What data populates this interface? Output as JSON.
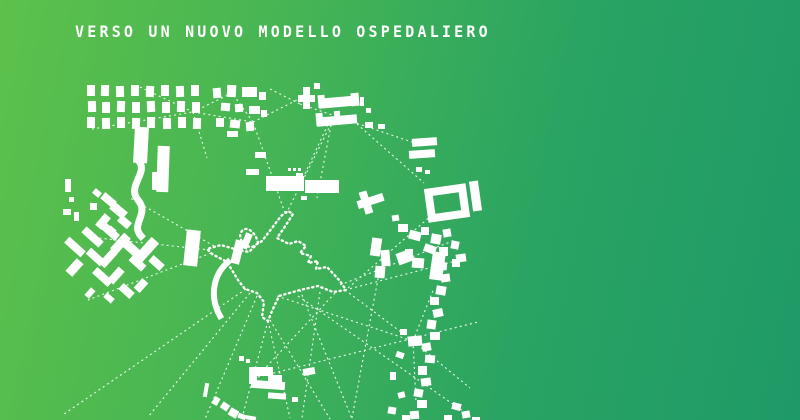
{
  "title": "VERSO UN NUOVO MODELLO OSPEDALIERO",
  "colors": {
    "gradient_left": "#5dc14b",
    "gradient_midleft": "#48b653",
    "gradient_midright": "#2aa462",
    "gradient_right": "#1e9a68",
    "ink": "#ffffff"
  },
  "map": {
    "description": "figure-ground site plan: white building footprints on green, dashed relation lines converging on dotted hospital footprint outline",
    "buildings": [
      [
        87,
        85,
        8,
        11,
        0
      ],
      [
        101,
        85,
        8,
        11,
        2
      ],
      [
        116,
        86,
        8,
        11,
        -2
      ],
      [
        131,
        85,
        8,
        11,
        0
      ],
      [
        146,
        86,
        8,
        11,
        3
      ],
      [
        161,
        85,
        8,
        11,
        0
      ],
      [
        176,
        86,
        8,
        11,
        -2
      ],
      [
        191,
        85,
        8,
        11,
        0
      ],
      [
        88,
        101,
        8,
        11,
        -2
      ],
      [
        102,
        102,
        8,
        11,
        0
      ],
      [
        117,
        101,
        8,
        11,
        2
      ],
      [
        132,
        102,
        8,
        11,
        0
      ],
      [
        147,
        101,
        8,
        11,
        -3
      ],
      [
        162,
        102,
        8,
        11,
        0
      ],
      [
        177,
        101,
        8,
        11,
        2
      ],
      [
        192,
        102,
        8,
        11,
        0
      ],
      [
        87,
        117,
        8,
        11,
        0
      ],
      [
        102,
        118,
        8,
        11,
        -2
      ],
      [
        117,
        117,
        8,
        11,
        0
      ],
      [
        132,
        118,
        8,
        11,
        2
      ],
      [
        147,
        117,
        8,
        11,
        0
      ],
      [
        163,
        118,
        8,
        11,
        -2
      ],
      [
        178,
        117,
        8,
        11,
        0
      ],
      [
        193,
        118,
        8,
        11,
        2
      ],
      [
        213,
        88,
        8,
        10,
        -5
      ],
      [
        227,
        85,
        9,
        12,
        3
      ],
      [
        242,
        87,
        15,
        10,
        0
      ],
      [
        259,
        92,
        7,
        8,
        0
      ],
      [
        221,
        103,
        9,
        8,
        5
      ],
      [
        235,
        104,
        8,
        8,
        -4
      ],
      [
        249,
        106,
        11,
        8,
        0
      ],
      [
        261,
        110,
        6,
        7,
        0
      ],
      [
        216,
        118,
        8,
        9,
        0
      ],
      [
        230,
        120,
        10,
        8,
        6
      ],
      [
        246,
        122,
        8,
        9,
        -5
      ],
      [
        227,
        131,
        11,
        6,
        0
      ],
      [
        303,
        87,
        7,
        22,
        0
      ],
      [
        298,
        95,
        17,
        7,
        0
      ],
      [
        314,
        83,
        6,
        6,
        0
      ],
      [
        318,
        95,
        7,
        13,
        -5
      ],
      [
        319,
        97,
        40,
        10,
        -5
      ],
      [
        351,
        93,
        8,
        13,
        -5
      ],
      [
        316,
        113,
        7,
        13,
        -5
      ],
      [
        317,
        116,
        40,
        9,
        -5
      ],
      [
        334,
        111,
        6,
        5,
        -5
      ],
      [
        365,
        122,
        8,
        6,
        0
      ],
      [
        378,
        124,
        7,
        5,
        0
      ],
      [
        360,
        97,
        4,
        9,
        0
      ],
      [
        366,
        108,
        5,
        5,
        0
      ],
      [
        246,
        169,
        13,
        6,
        0
      ],
      [
        255,
        152,
        11,
        6,
        0
      ],
      [
        288,
        168,
        3,
        3,
        0
      ],
      [
        293,
        168,
        3,
        3,
        0
      ],
      [
        298,
        168,
        3,
        3,
        0
      ],
      [
        266,
        176,
        38,
        15,
        0
      ],
      [
        305,
        180,
        34,
        13,
        0
      ],
      [
        296,
        173,
        7,
        5,
        0
      ],
      [
        301,
        196,
        6,
        4,
        0
      ],
      [
        134,
        127,
        14,
        36,
        3
      ],
      [
        157,
        146,
        12,
        46,
        2
      ],
      [
        152,
        172,
        5,
        18,
        0
      ],
      [
        93,
        190,
        8,
        6,
        40
      ],
      [
        101,
        196,
        15,
        8,
        40
      ],
      [
        90,
        203,
        7,
        7,
        0
      ],
      [
        110,
        206,
        17,
        9,
        40
      ],
      [
        99,
        214,
        8,
        15,
        40
      ],
      [
        118,
        218,
        13,
        8,
        40
      ],
      [
        107,
        227,
        8,
        8,
        40
      ],
      [
        65,
        179,
        6,
        13,
        0
      ],
      [
        69,
        197,
        5,
        5,
        0
      ],
      [
        63,
        209,
        8,
        6,
        0
      ],
      [
        74,
        212,
        5,
        9,
        0
      ],
      [
        64,
        243,
        22,
        8,
        42
      ],
      [
        81,
        233,
        23,
        8,
        42
      ],
      [
        99,
        227,
        21,
        8,
        42
      ],
      [
        116,
        233,
        9,
        21,
        42
      ],
      [
        70,
        259,
        9,
        17,
        42
      ],
      [
        86,
        253,
        19,
        8,
        42
      ],
      [
        104,
        249,
        8,
        19,
        42
      ],
      [
        123,
        245,
        19,
        9,
        42
      ],
      [
        92,
        273,
        21,
        8,
        42
      ],
      [
        112,
        267,
        8,
        17,
        42
      ],
      [
        129,
        259,
        17,
        8,
        42
      ],
      [
        142,
        237,
        10,
        25,
        42
      ],
      [
        149,
        259,
        15,
        8,
        42
      ],
      [
        119,
        287,
        15,
        8,
        42
      ],
      [
        137,
        279,
        8,
        13,
        42
      ],
      [
        104,
        295,
        10,
        6,
        42
      ],
      [
        87,
        288,
        6,
        10,
        42
      ],
      [
        185,
        230,
        14,
        36,
        6
      ],
      [
        233,
        240,
        9,
        24,
        14
      ],
      [
        243,
        233,
        7,
        16,
        22
      ],
      [
        416,
        167,
        6,
        5,
        0
      ],
      [
        425,
        170,
        5,
        4,
        0
      ],
      [
        412,
        138,
        25,
        8,
        -4
      ],
      [
        409,
        150,
        26,
        8,
        -4
      ],
      [
        471,
        181,
        9,
        30,
        -8
      ],
      [
        398,
        224,
        10,
        8,
        0
      ],
      [
        409,
        231,
        12,
        9,
        15
      ],
      [
        421,
        227,
        8,
        8,
        0
      ],
      [
        431,
        234,
        10,
        10,
        10
      ],
      [
        443,
        229,
        8,
        8,
        -10
      ],
      [
        424,
        245,
        12,
        8,
        20
      ],
      [
        439,
        247,
        9,
        9,
        0
      ],
      [
        451,
        241,
        8,
        8,
        12
      ],
      [
        405,
        249,
        8,
        8,
        0
      ],
      [
        456,
        254,
        10,
        8,
        -8
      ],
      [
        397,
        251,
        16,
        12,
        -20
      ],
      [
        412,
        258,
        12,
        10,
        5
      ],
      [
        431,
        252,
        13,
        28,
        8
      ],
      [
        452,
        259,
        8,
        8,
        0
      ],
      [
        437,
        262,
        10,
        8,
        5
      ],
      [
        441,
        274,
        9,
        8,
        -8
      ],
      [
        436,
        286,
        10,
        9,
        10
      ],
      [
        430,
        297,
        9,
        8,
        0
      ],
      [
        433,
        309,
        10,
        8,
        -12
      ],
      [
        427,
        320,
        9,
        9,
        8
      ],
      [
        430,
        332,
        10,
        8,
        0
      ],
      [
        408,
        336,
        14,
        10,
        -5
      ],
      [
        422,
        343,
        9,
        8,
        -10
      ],
      [
        425,
        355,
        10,
        8,
        5
      ],
      [
        418,
        366,
        9,
        9,
        0
      ],
      [
        421,
        378,
        10,
        8,
        -8
      ],
      [
        414,
        389,
        9,
        8,
        10
      ],
      [
        417,
        400,
        10,
        8,
        0
      ],
      [
        410,
        411,
        9,
        8,
        -5
      ],
      [
        400,
        329,
        7,
        6,
        0
      ],
      [
        396,
        352,
        8,
        6,
        20
      ],
      [
        390,
        372,
        6,
        8,
        0
      ],
      [
        398,
        392,
        7,
        6,
        -15
      ],
      [
        388,
        407,
        8,
        7,
        10
      ],
      [
        402,
        415,
        8,
        6,
        0
      ],
      [
        452,
        403,
        9,
        7,
        15
      ],
      [
        462,
        411,
        8,
        7,
        -10
      ],
      [
        444,
        415,
        8,
        6,
        0
      ],
      [
        472,
        417,
        8,
        3,
        0
      ],
      [
        357,
        197,
        27,
        8,
        -18
      ],
      [
        362,
        191,
        8,
        23,
        -18
      ],
      [
        371,
        238,
        10,
        18,
        8
      ],
      [
        381,
        250,
        9,
        16,
        -5
      ],
      [
        375,
        266,
        10,
        12,
        5
      ],
      [
        392,
        215,
        7,
        6,
        -10
      ],
      [
        250,
        367,
        23,
        9,
        0
      ],
      [
        249,
        367,
        8,
        17,
        0
      ],
      [
        268,
        375,
        14,
        8,
        0
      ],
      [
        251,
        381,
        34,
        8,
        4
      ],
      [
        268,
        393,
        18,
        6,
        4
      ],
      [
        239,
        356,
        5,
        5,
        0
      ],
      [
        246,
        359,
        4,
        4,
        0
      ],
      [
        292,
        397,
        6,
        5,
        0
      ],
      [
        303,
        368,
        12,
        7,
        -10
      ],
      [
        204,
        383,
        4,
        14,
        10
      ],
      [
        213,
        397,
        6,
        8,
        30
      ],
      [
        221,
        403,
        8,
        7,
        35
      ],
      [
        229,
        409,
        9,
        8,
        30
      ],
      [
        238,
        414,
        8,
        5,
        20
      ],
      [
        246,
        416,
        10,
        4,
        10
      ]
    ],
    "ribbons": [
      {
        "d": "M138,160 C150,172 126,186 138,200 C150,214 130,224 141,236",
        "sw": 7
      },
      {
        "d": "M228,262 C212,276 210,298 220,316",
        "sw": 6
      }
    ],
    "rings": [
      {
        "x": 430,
        "y": 190,
        "w": 34,
        "h": 26,
        "sw": 8,
        "rot": -8
      }
    ],
    "hospital_outline": "M258,243 C256,233 247,225 242,231 C237,237 243,247 252,247 L262,241 L272,228 L281,216 L288,211 L293,214 L284,228 L277,238 L289,244 L298,241 L306,246 L300,253 L311,256 L308,263 L318,261 L316,269 L327,267 L340,281 L346,290 L333,292 L318,286 L300,290 L279,296 L272,311 L268,321 L262,317 L264,302 L257,293 L245,289 L238,280 L227,262 L212,254 L207,249 L221,245 L238,250 L249,252 Z",
    "links": [
      [
        92,
        129,
        193,
        112
      ],
      [
        140,
        87,
        193,
        112
      ],
      [
        193,
        112,
        232,
        93
      ],
      [
        193,
        112,
        207,
        158
      ],
      [
        193,
        112,
        253,
        122
      ],
      [
        253,
        122,
        232,
        93
      ],
      [
        253,
        122,
        297,
        100
      ],
      [
        270,
        89,
        300,
        104
      ],
      [
        300,
        104,
        347,
        120
      ],
      [
        347,
        120,
        412,
        142
      ],
      [
        357,
        124,
        424,
        183
      ],
      [
        330,
        120,
        303,
        178
      ],
      [
        332,
        120,
        317,
        198
      ],
      [
        285,
        213,
        253,
        122
      ],
      [
        286,
        214,
        332,
        122
      ],
      [
        210,
        250,
        98,
        238
      ],
      [
        211,
        253,
        88,
        300
      ],
      [
        214,
        246,
        130,
        198
      ],
      [
        246,
        289,
        64,
        414
      ],
      [
        250,
        293,
        148,
        417
      ],
      [
        257,
        296,
        205,
        419
      ],
      [
        268,
        321,
        242,
        418
      ],
      [
        268,
        321,
        290,
        418
      ],
      [
        270,
        320,
        330,
        419
      ],
      [
        277,
        296,
        413,
        341
      ],
      [
        345,
        290,
        413,
        341
      ],
      [
        413,
        341,
        434,
        288
      ],
      [
        413,
        341,
        416,
        402
      ],
      [
        413,
        341,
        470,
        388
      ],
      [
        320,
        292,
        302,
        418
      ],
      [
        300,
        290,
        352,
        419
      ],
      [
        335,
        293,
        256,
        378
      ],
      [
        258,
        377,
        478,
        322
      ],
      [
        298,
        296,
        470,
        416
      ],
      [
        380,
        268,
        352,
        418
      ],
      [
        432,
        215,
        348,
        288
      ],
      [
        340,
        285,
        455,
        240
      ],
      [
        345,
        290,
        452,
        262
      ]
    ]
  }
}
